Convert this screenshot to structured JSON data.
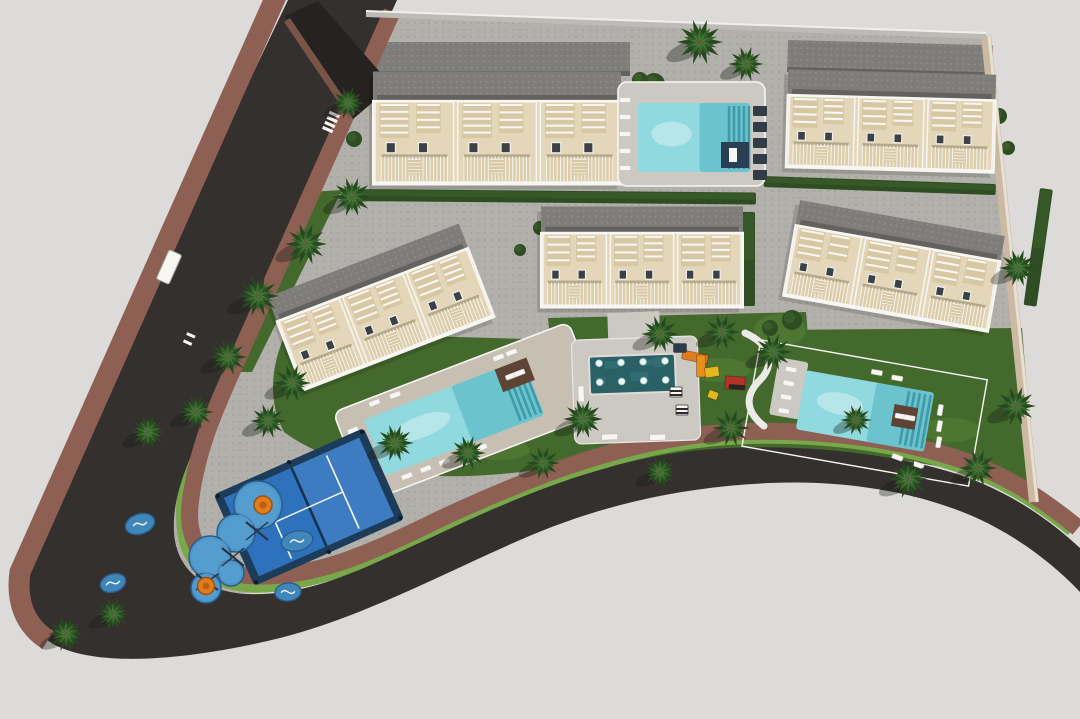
{
  "canvas": {
    "w": 1080,
    "h": 719,
    "background": "#dcdbd9"
  },
  "palette": {
    "bg": "#dcdbd9",
    "asphalt": "#34302e",
    "asphalt_light": "#403b38",
    "sidewalk": "#8d6053",
    "paving": "#b2b0ab",
    "paving_dot": "#a4a29d",
    "deck_light": "#ccc9c3",
    "deck_warm": "#c6bfb2",
    "grass": "#44692d",
    "grass_light": "#578036",
    "verge": "#78a84a",
    "hedge": "#2e4d22",
    "water": "#8fd9df",
    "water_deep": "#5fbcc7",
    "steps": "#3f9aa8",
    "spa_water": "#2a6066",
    "wall": "#e4d6b8",
    "wall_shade": "#d8c7a3",
    "balcony": "#dccdab",
    "roof": "#7e7d7a",
    "roof_dot": "#908f8b",
    "eave": "#63625f",
    "white": "#f7f6f3",
    "window_dark": "#3c4148",
    "navy": "#2b3f54",
    "wood": "#5d4435",
    "court_outer": "#1d3c5a",
    "court_blue": "#2e71bc",
    "kids_blue": "#4e97cb",
    "kids_blue_dark": "#2b5d8a",
    "small_pool": "#3f86bb",
    "orange": "#e07b1e",
    "red": "#b5342a",
    "yellow": "#e5b71f",
    "palm_dark": "#27491f",
    "palm_mid": "#35612a",
    "palm_light": "#47793a",
    "trunk": "#6b5742",
    "tan": "#cbb9a1",
    "tan_light": "#e8e0d2",
    "shadow": "rgba(22,25,20,0.34)"
  },
  "roads": {
    "asphalt_path": "M 288,0 L 397,0 L 216,400 C 190,458 172,492 174,532 C 176,568 202,592 248,594 C 310,596 360,570 430,538 C 510,500 600,460 700,450 C 790,442 890,452 960,475 C 1010,492 1050,520 1080,548 L 1080,592 C 1050,560 1010,532 970,515 C 910,490 840,480 770,483 C 680,487 600,505 520,540 C 440,575 360,618 280,638 C 190,660 100,668 55,645 C 25,628 8,600 14,575 L 288,0 Z",
    "outer_sidewalk_path": "M 277,-6 L 20,572 C 16,600 24,625 48,640",
    "inner_sidewalk_path": "M 392,12 L 230,376 C 214,412 196,452 190,505 C 186,548 210,574 254,576 C 318,578 372,552 442,518 C 522,481 612,444 706,434 C 796,426 888,436 956,458 C 1006,474 1044,500 1078,528",
    "green_verge_path": "M 206,428 C 184,465 178,510 186,544 C 196,574 226,588 266,586 C 328,582 380,556 448,523 C 528,486 616,450 710,440 C 798,432 886,442 952,464 C 1000,478 1038,503 1072,530",
    "retaining_wall_points": "285,16 318,1 392,86 353,119",
    "retaining_wall_edge": {
      "x1": 287,
      "y1": 20,
      "x2": 352,
      "y2": 116
    }
  },
  "site": {
    "paving_path": "M 392,14 L 986,36 L 1036,505 C 1002,478 958,462 900,452 C 820,440 760,440 700,448 C 610,458 530,494 450,530 C 380,562 330,586 268,592 C 198,598 146,580 126,546 C 108,516 112,468 140,430 C 162,402 192,396 222,392 L 392,14 Z",
    "entrance_quad": "354,64 398,52 428,142 384,154",
    "top_wall": {
      "x1": 366,
      "y1": 14,
      "x2": 986,
      "y2": 36
    },
    "right_wall": {
      "x1": 986,
      "y1": 36,
      "x2": 1034,
      "y2": 502
    },
    "roof_slabs": [
      {
        "x": 368,
        "y": 42,
        "w": 262,
        "h": 34,
        "rot": 0
      },
      {
        "x": 788,
        "y": 40,
        "w": 205,
        "h": 32,
        "rot": 1.5
      }
    ],
    "grass_areas": [
      "M 548,318 L 806,312 L 818,458 C 760,446 700,448 640,462 C 610,468 580,472 562,470 Z",
      "M 286,332 C 270,368 268,402 284,432 C 330,466 400,478 470,476 C 520,474 570,466 614,454 L 604,366 L 560,340 Z",
      "M 772,330 L 1022,328 L 1036,502 C 996,480 950,466 898,460 C 856,455 812,452 790,454 Z",
      "M 342,190 L 310,192 L 222,372 L 252,372 Z"
    ],
    "grass_patches": [
      [
        600,
        400,
        40,
        16
      ],
      [
        720,
        370,
        30,
        12
      ],
      [
        850,
        400,
        46,
        18
      ],
      [
        950,
        430,
        30,
        12
      ],
      [
        380,
        420,
        36,
        14
      ],
      [
        500,
        450,
        30,
        10
      ],
      [
        780,
        330,
        26,
        16
      ]
    ],
    "hedges": [
      {
        "x": 346,
        "y": 189,
        "w": 410,
        "h": 12,
        "rot": 0.5
      },
      {
        "x": 764,
        "y": 176,
        "w": 232,
        "h": 11,
        "rot": 2
      },
      {
        "x": 742,
        "y": 212,
        "w": 13,
        "h": 94,
        "rot": 0
      },
      {
        "x": 1040,
        "y": 188,
        "w": 13,
        "h": 118,
        "rot": 8
      }
    ],
    "bushes": [
      [
        654,
        84,
        11
      ],
      [
        668,
        92,
        8
      ],
      [
        640,
        80,
        8
      ],
      [
        351,
        108,
        9
      ],
      [
        354,
        139,
        8
      ],
      [
        999,
        116,
        8
      ],
      [
        1008,
        148,
        7
      ],
      [
        540,
        228,
        7
      ],
      [
        520,
        250,
        6
      ],
      [
        792,
        320,
        10
      ],
      [
        770,
        328,
        8
      ]
    ]
  },
  "buildings": [
    {
      "id": "building-1",
      "cx": 497,
      "cy": 128,
      "w": 248,
      "h": 113,
      "rot": 0,
      "modules": 3
    },
    {
      "id": "building-2",
      "cx": 891,
      "cy": 121,
      "w": 208,
      "h": 98,
      "rot": 1.5,
      "modules": 3
    },
    {
      "id": "building-3",
      "cx": 381,
      "cy": 307,
      "w": 205,
      "h": 100,
      "rot": -21,
      "modules": 3
    },
    {
      "id": "building-4",
      "cx": 642,
      "cy": 257,
      "w": 202,
      "h": 101,
      "rot": 0,
      "modules": 3
    },
    {
      "id": "building-5",
      "cx": 894,
      "cy": 266,
      "w": 208,
      "h": 97,
      "rot": 10,
      "modules": 3
    }
  ],
  "pools": [
    {
      "id": "pool-top",
      "cx": 691,
      "cy": 134,
      "rot": 0,
      "deck": [
        -73,
        -52,
        147,
        104
      ],
      "water": [
        -53,
        -31,
        112,
        69
      ],
      "steps_x": [
        38,
        58
      ],
      "navy_platform": [
        30,
        8,
        28,
        26
      ],
      "towel": [
        38,
        14,
        8,
        14
      ],
      "dark_panels": [
        [
          62,
          -28
        ],
        [
          62,
          -12
        ],
        [
          62,
          4
        ],
        [
          62,
          20
        ],
        [
          62,
          36
        ]
      ],
      "loungers": [
        [
          -66,
          -34,
          0
        ],
        [
          -66,
          -17,
          0
        ],
        [
          -66,
          0,
          0
        ],
        [
          -66,
          17,
          0
        ],
        [
          -66,
          34,
          0
        ]
      ]
    },
    {
      "id": "pool-left",
      "cx": 468,
      "cy": 412,
      "rot": -21,
      "deck": [
        -126,
        -48,
        252,
        96
      ],
      "water": [
        -100,
        -30,
        170,
        60
      ],
      "steps_x": [
        46,
        68
      ],
      "wood_platform": [
        40,
        -30,
        34,
        24
      ],
      "loungers": [
        [
          -114,
          -24,
          0
        ],
        [
          -114,
          -10,
          0
        ],
        [
          -114,
          4,
          0
        ],
        [
          -114,
          18,
          0
        ],
        [
          -80,
          38,
          0
        ],
        [
          -60,
          38,
          0
        ],
        [
          -40,
          38,
          0
        ],
        [
          -20,
          38,
          0
        ],
        [
          0,
          38,
          0
        ],
        [
          -84,
          -42,
          0
        ],
        [
          -62,
          -42,
          0
        ],
        [
          48,
          -40,
          0
        ],
        [
          62,
          -40,
          0
        ]
      ]
    },
    {
      "id": "pool-right",
      "cx": 865,
      "cy": 411,
      "rot": 10,
      "fence": [
        -115,
        -52,
        230,
        108
      ],
      "pad": [
        -94,
        -38,
        30,
        58
      ],
      "water": [
        -65,
        -30,
        130,
        60
      ],
      "steps_x": [
        40,
        62
      ],
      "wood_platform": [
        28,
        -12,
        24,
        22
      ],
      "loungers": [
        [
          -80,
          -28,
          0
        ],
        [
          -80,
          -14,
          0
        ],
        [
          -80,
          0,
          0
        ],
        [
          -80,
          14,
          0
        ],
        [
          74,
          -14,
          90
        ],
        [
          76,
          2,
          90
        ],
        [
          78,
          18,
          90
        ],
        [
          40,
          40,
          10
        ],
        [
          62,
          44,
          10
        ],
        [
          5,
          -40,
          0
        ],
        [
          26,
          -38,
          0
        ]
      ]
    }
  ],
  "spa": {
    "cx": 636,
    "cy": 390,
    "rot": -2,
    "pad": [
      -63,
      -52,
      126,
      104
    ],
    "stem": [
      -26,
      -78,
      52,
      30
    ],
    "basin": [
      -46,
      -35,
      86,
      38
    ],
    "jet_cols": [
      -36,
      -14,
      8,
      30
    ],
    "jet_rows": [
      -28,
      -9
    ],
    "benches": [
      [
        -36,
        43,
        16,
        6
      ],
      [
        12,
        45,
        16,
        6
      ],
      [
        -58,
        -6,
        6,
        16
      ]
    ]
  },
  "padel_court": {
    "cx": 309,
    "cy": 507,
    "rot": -24,
    "outer": [
      -82,
      -50,
      164,
      100
    ],
    "inner": [
      -74,
      -43,
      148,
      86
    ]
  },
  "kids_area": {
    "blob": [
      [
        258,
        505,
        24
      ],
      [
        236,
        533,
        19
      ],
      [
        210,
        557,
        21
      ],
      [
        231,
        573,
        13
      ],
      [
        206,
        588,
        15
      ]
    ],
    "orange": [
      [
        263,
        505,
        9
      ],
      [
        206,
        586,
        8.5
      ]
    ],
    "frames": [
      [
        246,
        522,
        268,
        540
      ],
      [
        222,
        548,
        244,
        566
      ],
      [
        196,
        574,
        218,
        590
      ]
    ],
    "mini_pools": [
      [
        140,
        524,
        15,
        10,
        -18
      ],
      [
        297,
        541,
        16,
        10,
        -12
      ],
      [
        113,
        583,
        13,
        9,
        -18
      ],
      [
        288,
        592,
        13,
        9,
        -6
      ]
    ]
  },
  "playground": {
    "path": {
      "d": "M 745,333 C 770,344 776,364 760,380 C 744,396 746,412 764,426",
      "width": 7
    },
    "items": [
      {
        "type": "rect",
        "x": 695,
        "y": 357,
        "w": 26,
        "h": 9,
        "rot": 12,
        "fill": "#e07b1e"
      },
      {
        "type": "rect",
        "x": 701,
        "y": 366,
        "w": 9,
        "h": 22,
        "rot": 0,
        "fill": "#e8901e"
      },
      {
        "type": "rect",
        "x": 712,
        "y": 372,
        "w": 14,
        "h": 10,
        "rot": -8,
        "fill": "#e5b71f"
      },
      {
        "type": "rect",
        "x": 735,
        "y": 383,
        "w": 20,
        "h": 13,
        "rot": 4,
        "fill": "#b5342a"
      },
      {
        "type": "rect",
        "x": 737,
        "y": 387,
        "w": 16,
        "h": 4,
        "rot": 4,
        "fill": "#24272b"
      },
      {
        "type": "rect",
        "x": 680,
        "y": 348,
        "w": 13,
        "h": 9,
        "rot": 0,
        "fill": "#2c3a50"
      },
      {
        "type": "rect",
        "x": 713,
        "y": 395,
        "w": 10,
        "h": 8,
        "rot": 20,
        "fill": "#e5b71f"
      },
      {
        "type": "table",
        "x": 676,
        "y": 392
      },
      {
        "type": "table",
        "x": 682,
        "y": 410
      }
    ]
  },
  "palm_trees": [
    [
      700,
      42,
      1.1
    ],
    [
      746,
      64,
      0.85
    ],
    [
      348,
      103,
      0.8
    ],
    [
      352,
      197,
      0.95
    ],
    [
      306,
      244,
      1.0
    ],
    [
      258,
      296,
      1.0
    ],
    [
      228,
      357,
      0.9
    ],
    [
      196,
      412,
      0.85
    ],
    [
      292,
      383,
      0.9
    ],
    [
      268,
      421,
      0.85
    ],
    [
      148,
      432,
      0.85
    ],
    [
      113,
      614,
      0.8
    ],
    [
      66,
      634,
      0.85
    ],
    [
      395,
      443,
      0.9
    ],
    [
      468,
      453,
      0.85
    ],
    [
      543,
      463,
      0.8
    ],
    [
      583,
      419,
      0.95
    ],
    [
      660,
      334,
      0.9
    ],
    [
      722,
      332,
      0.85
    ],
    [
      731,
      428,
      0.9
    ],
    [
      660,
      472,
      0.8
    ],
    [
      773,
      352,
      0.9
    ],
    [
      856,
      420,
      0.75
    ],
    [
      908,
      479,
      0.95
    ],
    [
      978,
      468,
      0.9
    ],
    [
      1016,
      406,
      0.95
    ],
    [
      1018,
      268,
      0.9
    ]
  ],
  "markings": {
    "crosswalk": {
      "x": 327,
      "y": 131,
      "rot": -66,
      "bars": 4
    },
    "dashes": {
      "x": 187,
      "y": 344,
      "rot": -66,
      "bars": 2
    },
    "shelter": {
      "x": 169,
      "y": 267,
      "rot": -66,
      "w": 32,
      "h": 14
    }
  }
}
